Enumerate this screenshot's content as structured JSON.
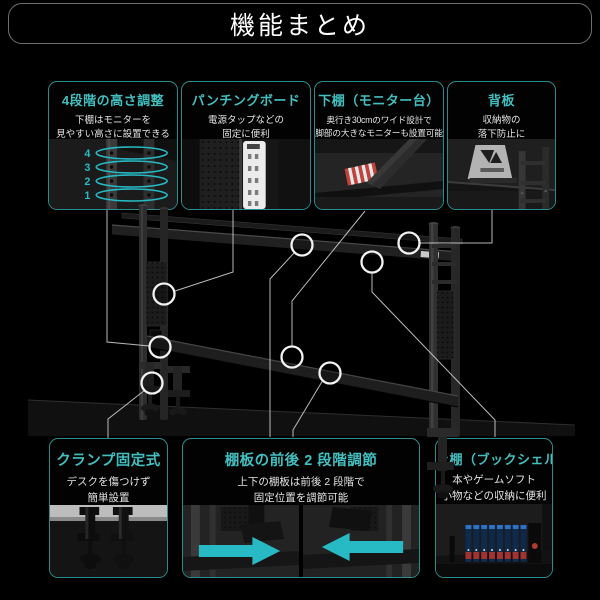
{
  "header": {
    "title": "機能まとめ"
  },
  "accent": {
    "teal_title": "#43bfbf",
    "teal_border": "#2c8c8d",
    "teal_bright": "#27bac4",
    "connector_line": "#d9d9d9",
    "background": "#000000"
  },
  "features": [
    {
      "key": "height-adjustment",
      "title": "4段階の高さ調整",
      "desc1": "下棚はモニターを",
      "desc2": "見やすい高さに設置できる",
      "levels": [
        "4",
        "3",
        "2",
        "1"
      ]
    },
    {
      "key": "punching-board",
      "title": "パンチングボード",
      "desc1": "電源タップなどの",
      "desc2": "固定に便利"
    },
    {
      "key": "lower-shelf",
      "title": "下棚（モニター台）",
      "desc1": "奥行き30cmのワイド設計で",
      "desc2": "脚部の大きなモニターも設置可能"
    },
    {
      "key": "back-panel",
      "title": "背板",
      "desc1": "収納物の",
      "desc2": "落下防止に"
    },
    {
      "key": "clamp-mount",
      "title": "クランプ固定式",
      "desc1": "デスクを傷つけず",
      "desc2": "簡単設置"
    },
    {
      "key": "shelf-depth-adjust",
      "title": "棚板の前後 2 段階調節",
      "desc1": "上下の棚板は前後 2 段階で",
      "desc2": "固定位置を調節可能"
    },
    {
      "key": "upper-shelf",
      "title": "上棚（ブックシェルフ）",
      "desc1": "本やゲームソフト",
      "desc2": "小物などの収納に便利"
    }
  ]
}
